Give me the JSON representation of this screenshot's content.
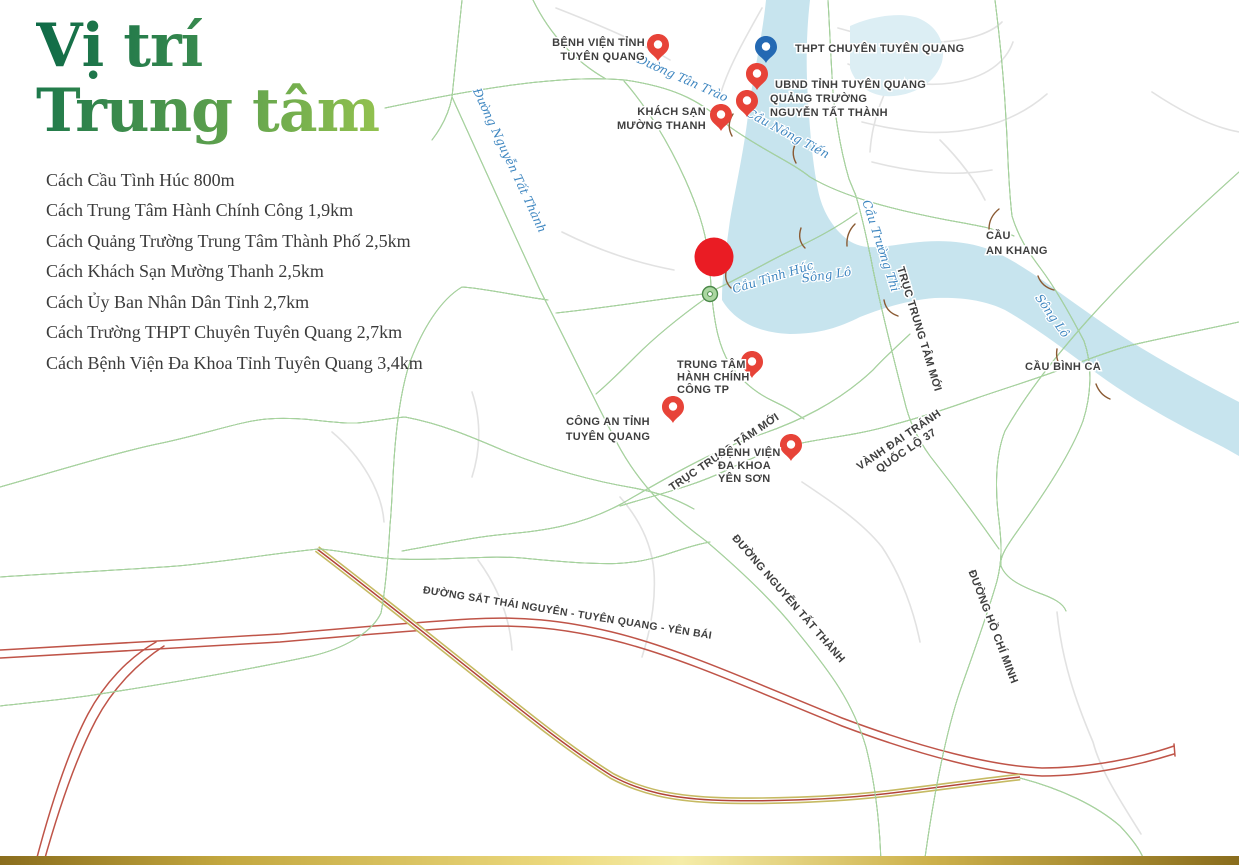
{
  "title": {
    "line1": "Vị trí",
    "line2": "Trung tâm"
  },
  "distances": [
    "Cách Cầu Tình Húc 800m",
    "Cách Trung Tâm Hành Chính Công 1,9km",
    "Cách Quảng Trường Trung Tâm Thành Phố 2,5km",
    "Cách Khách Sạn Mường Thanh 2,5km",
    "Cách Ủy Ban Nhân Dân Tỉnh 2,7km",
    "Cách Trường THPT Chuyên Tuyên Quang 2,7km",
    "Cách Bệnh Viện Đa Khoa Tỉnh Tuyên Quang 3,4km"
  ],
  "colors": {
    "title_green_dark": "#0e6a47",
    "title_green_light": "#93c24f",
    "road_fill": "#abd7a1",
    "road_outline": "#4a8748",
    "river_blue": "#c7e4ee",
    "pin_red": "#e74338",
    "pin_blue": "#2469b3",
    "railway_red": "#bf5448",
    "gold_accent": "#c6ba62"
  },
  "map": {
    "pins": [
      {
        "name": "benh-vien-tinh-tuyen-quang",
        "color": "red",
        "lines": [
          "BỆNH VIỆN TỈNH",
          "TUYÊN QUANG"
        ]
      },
      {
        "name": "thpt-chuyen-tuyen-quang",
        "color": "blue",
        "lines": [
          "THPT CHUYÊN TUYÊN QUANG"
        ]
      },
      {
        "name": "ubnd-tinh-tuyen-quang",
        "color": "red",
        "lines": [
          "UBND TỈNH TUYÊN QUANG"
        ]
      },
      {
        "name": "quang-truong-nguyen-tat-thanh",
        "color": "red",
        "lines": [
          "QUẢNG TRƯỜNG",
          "NGUYỄN TẤT THÀNH"
        ]
      },
      {
        "name": "khach-san-muong-thanh",
        "color": "red",
        "lines": [
          "KHÁCH SẠN",
          "MƯỜNG THANH"
        ]
      },
      {
        "name": "trung-tam-hanh-chinh-cong-tp",
        "color": "red",
        "lines": [
          "TRUNG TÂM",
          "HÀNH CHÍNH",
          "CÔNG TP"
        ]
      },
      {
        "name": "cong-an-tinh-tuyen-quang",
        "color": "red",
        "lines": [
          "CÔNG AN TỈNH",
          "TUYÊN QUANG"
        ]
      },
      {
        "name": "benh-vien-da-khoa-yen-son",
        "color": "red",
        "lines": [
          "BỆNH VIỆN",
          "ĐA KHOA",
          "YÊN SƠN"
        ]
      }
    ],
    "labels": {
      "tan_trao": "Đường Tân Trào",
      "nguyen_tat_thanh_blue": "Đường Nguyễn Tất Thành",
      "cau_nong_tien": "Cầu Nông Tiến",
      "cau_tinh_huc": "Cầu Tình Húc",
      "song_lo": "Sông Lô",
      "cau_truong_thi": "Cầu Trường Thi",
      "truc_trung_tam_moi": "TRỤC TRUNG TÂM MỚI",
      "vanh_dai_1": "VÀNH ĐAI TRÁNH",
      "vanh_dai_2": "QUỐC LỘ 37",
      "cau_an_khang_1": "CẦU",
      "cau_an_khang_2": "AN KHANG",
      "cau_binh_ca": "CẦU BÌNH CA",
      "nguyen_tat_thanh_road": "ĐƯỜNG NGUYỄN TẤT THÀNH",
      "ho_chi_minh": "ĐƯỜNG HỒ CHÍ MINH",
      "duong_sat": "ĐƯỜNG SẮT THÁI NGUYÊN - TUYÊN QUANG - YÊN BÁI"
    },
    "project_dot": {
      "name": "project-location-dot",
      "color": "#ea1c24"
    }
  }
}
